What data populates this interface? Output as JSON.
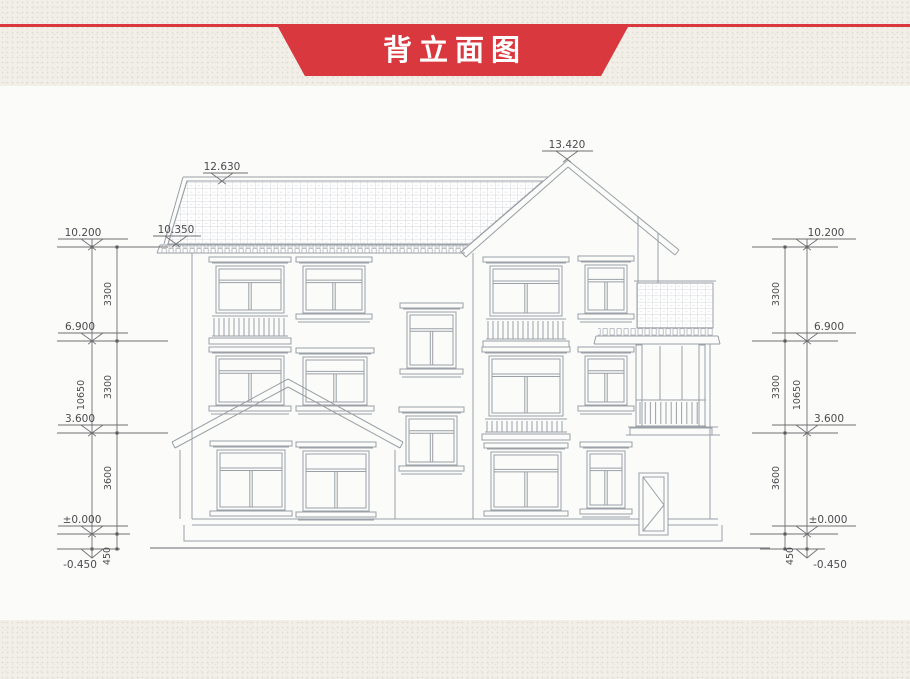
{
  "banner": {
    "title": "背立面图"
  },
  "colors": {
    "banner_red": "#d9383e",
    "paper": "#f2efe8",
    "line_gray": "#9aa0a6"
  },
  "dims": {
    "left": {
      "levels": [
        "10.200",
        "6.900",
        "3.600",
        "±0.000",
        "-0.450"
      ],
      "segments": [
        "3300",
        "3300",
        "3600",
        "450"
      ],
      "total": "10650"
    },
    "right": {
      "levels": [
        "10.200",
        "6.900",
        "3.600",
        "±0.000",
        "-0.450"
      ],
      "segments": [
        "3300",
        "3300",
        "3600",
        "450"
      ],
      "total": "10650"
    },
    "roof": {
      "left_ridge": "12.630",
      "left_eave": "10.350",
      "main_peak": "13.420"
    }
  }
}
